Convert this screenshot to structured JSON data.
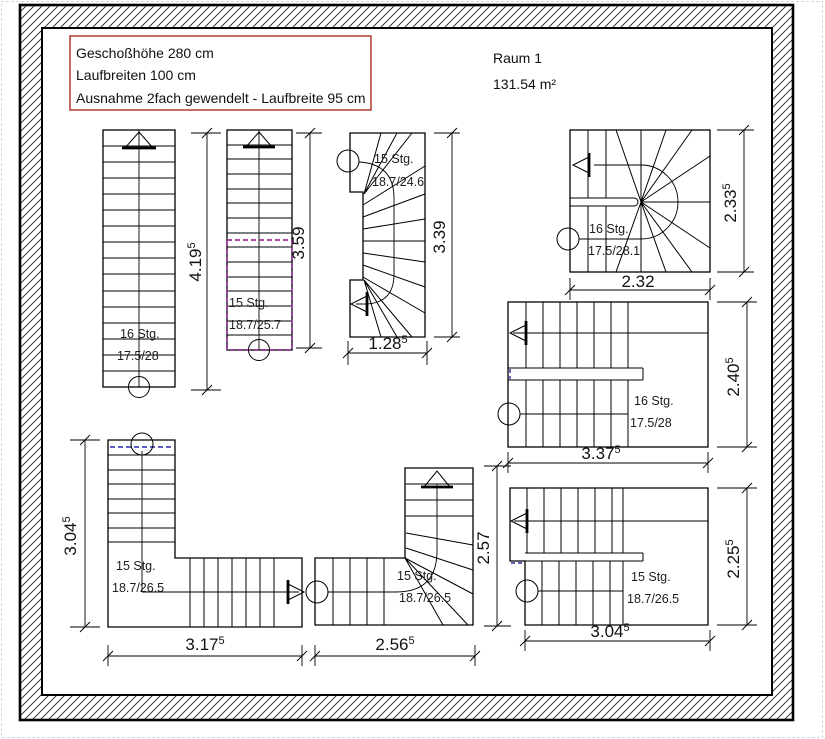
{
  "info_box": {
    "line1": "Geschoßhöhe 280 cm",
    "line2": "Laufbreiten 100 cm",
    "line3": "Ausnahme 2fach gewendelt - Laufbreite 95 cm"
  },
  "room": {
    "name": "Raum 1",
    "area": "131.54 m²"
  },
  "stairs": {
    "s1": {
      "steps": "16 Stg.",
      "ratio": "17.5/28"
    },
    "s2": {
      "steps": "15 Stg.",
      "ratio": "18.7/25.7"
    },
    "s3": {
      "steps": "15 Stg.",
      "ratio": "18.7/24.6"
    },
    "s4": {
      "steps": "16 Stg.",
      "ratio": "17.5/28.1"
    },
    "s5": {
      "steps": "16 Stg.",
      "ratio": "17.5/28"
    },
    "s6": {
      "steps": "15 Stg.",
      "ratio": "18.7/26.5"
    },
    "s7": {
      "steps": "15 Stg.",
      "ratio": "18.7/26.5"
    },
    "s8": {
      "steps": "15 Stg.",
      "ratio": "18.7/26.5"
    }
  },
  "dims": {
    "d419": {
      "v": "4.19",
      "sup": "5"
    },
    "d359": {
      "v": "3.59",
      "sup": ""
    },
    "d339": {
      "v": "3.39",
      "sup": ""
    },
    "d128": {
      "v": "1.28",
      "sup": "5"
    },
    "d233": {
      "v": "2.33",
      "sup": "5"
    },
    "d232": {
      "v": "2.32",
      "sup": ""
    },
    "d240": {
      "v": "2.40",
      "sup": "5"
    },
    "d337": {
      "v": "3.37",
      "sup": "5"
    },
    "d225": {
      "v": "2.25",
      "sup": "5"
    },
    "d304r": {
      "v": "3.04",
      "sup": "5"
    },
    "d304l": {
      "v": "3.04",
      "sup": "5"
    },
    "d317": {
      "v": "3.17",
      "sup": "5"
    },
    "d256": {
      "v": "2.56",
      "sup": "5"
    },
    "d257": {
      "v": "2.57",
      "sup": ""
    }
  },
  "colors": {
    "selection": "#993399",
    "marker_blue": "#2b2ba8",
    "info_border": "#b23a31",
    "line": "#000000"
  }
}
